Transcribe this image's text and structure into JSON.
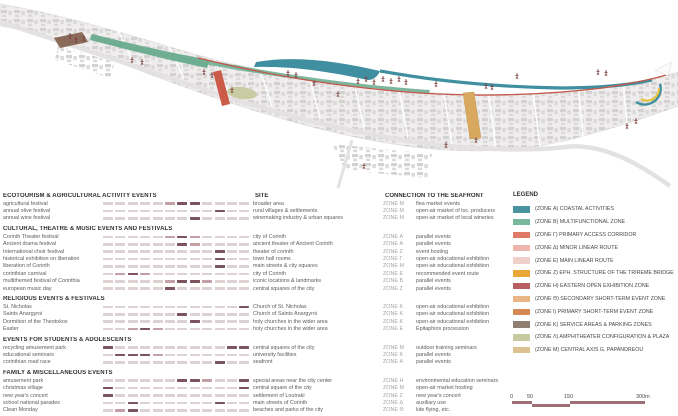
{
  "table": {
    "column_headers": {
      "site": "SITE",
      "connection": "CONNECTION TO THE SEAFRONT"
    },
    "groups": [
      {
        "header": "ECOTOURISM & AGRICULTURAL ACTIVITY EVENTS",
        "rows": [
          {
            "event": "agricultural festival",
            "site": "broader area",
            "zone": "ZONE Μ",
            "connection": "flea market events",
            "months": [
              0,
              0,
              0,
              0,
              0,
              1,
              2,
              2,
              0,
              0,
              0,
              0
            ]
          },
          {
            "event": "annual olive festival",
            "site": "rural villages & settlements",
            "zone": "ZONE Μ",
            "connection": "open-air market of loc. producers",
            "months": [
              0,
              0,
              0,
              0,
              0,
              0,
              0,
              0,
              0,
              2,
              0,
              0
            ]
          },
          {
            "event": "annual wine festival",
            "site": "winemaking industry & urban squares",
            "zone": "ZONE Μ",
            "connection": "open-air market of local wineries",
            "months": [
              0,
              0,
              0,
              0,
              0,
              0,
              0,
              2,
              0,
              0,
              0,
              0
            ]
          }
        ]
      },
      {
        "header": "CULTURAL, THEATRE & MUSIC EVENTS AND FESTIVALS",
        "rows": [
          {
            "event": "Corinth Theater festival",
            "site": "city of Corinth",
            "zone": "ZONE Α",
            "connection": "parallel events",
            "months": [
              0,
              0,
              0,
              0,
              0,
              1,
              2,
              1,
              0,
              0,
              0,
              0
            ]
          },
          {
            "event": "Ancient drama festival",
            "site": "ancient theater of Ancient Corinth",
            "zone": "ZONE Α",
            "connection": "parallel events",
            "months": [
              0,
              0,
              0,
              0,
              0,
              0,
              2,
              1,
              0,
              0,
              0,
              0
            ]
          },
          {
            "event": "International choir festival",
            "site": "theater of corinth",
            "zone": "ZONE Ζ",
            "connection": "event hosting",
            "months": [
              0,
              0,
              0,
              0,
              0,
              0,
              0,
              0,
              0,
              2,
              0,
              0
            ]
          },
          {
            "event": "historical exhibition on liberation",
            "site": "town hall rooms",
            "zone": "ZONE Γ",
            "connection": "open-air educational exhibition",
            "months": [
              0,
              0,
              0,
              0,
              0,
              0,
              0,
              0,
              0,
              2,
              0,
              0
            ]
          },
          {
            "event": "liberation of Corinth",
            "site": "main streets & city squares",
            "zone": "ZONE Μ",
            "connection": "open-air educational exhibition",
            "months": [
              0,
              0,
              0,
              0,
              0,
              0,
              0,
              0,
              0,
              2,
              0,
              0
            ]
          },
          {
            "event": "corinthian carnival",
            "site": "city of Corinth",
            "zone": "ZONE Ε",
            "connection": "recommended event route",
            "months": [
              0,
              1,
              2,
              1,
              0,
              0,
              0,
              0,
              0,
              0,
              0,
              0
            ]
          },
          {
            "event": "multithemed festival of Corinthia",
            "site": "iconic locations & landmarks",
            "zone": "ZONE Β",
            "connection": "parallel events",
            "months": [
              0,
              0,
              0,
              0,
              0,
              1,
              2,
              2,
              1,
              0,
              0,
              0
            ]
          },
          {
            "event": "european music day",
            "site": "central squares of the city",
            "zone": "ZONE Ζ",
            "connection": "parallel events",
            "months": [
              0,
              0,
              0,
              0,
              0,
              2,
              0,
              0,
              0,
              0,
              0,
              0
            ]
          }
        ]
      },
      {
        "header": "RELIGIOUS EVENTS & FESTIVALS",
        "rows": [
          {
            "event": "St. Nicholas",
            "site": "Church of St. Nicholas",
            "zone": "ZONE Κ",
            "connection": "open-air educational exhibition",
            "months": [
              0,
              0,
              0,
              0,
              0,
              0,
              0,
              0,
              0,
              0,
              0,
              2
            ]
          },
          {
            "event": "Saints Anargyroi",
            "site": "Church of Saints Anargyroi",
            "zone": "ZONE Κ",
            "connection": "open-air educational exhibition",
            "months": [
              0,
              0,
              0,
              0,
              0,
              0,
              2,
              0,
              0,
              0,
              0,
              0
            ]
          },
          {
            "event": "Dormition of the Theotokos",
            "site": "holy churches in the wider area",
            "zone": "ZONE Κ",
            "connection": "open-air educational exhibition",
            "months": [
              0,
              0,
              0,
              0,
              0,
              0,
              0,
              2,
              0,
              0,
              0,
              0
            ]
          },
          {
            "event": "Easter",
            "site": "holy churches in the wider area",
            "zone": "ZONE Ε",
            "connection": "Epitaphios procession",
            "months": [
              0,
              0,
              1,
              2,
              1,
              0,
              0,
              0,
              0,
              0,
              0,
              0
            ]
          }
        ]
      },
      {
        "header": "EVENTS FOR STUDENTS & ADOLESCENTS",
        "rows": [
          {
            "event": "recycling amusement park",
            "site": "central squares of the city",
            "zone": "ZONE Μ",
            "connection": "outdoor training seminars",
            "months": [
              2,
              0,
              0,
              0,
              0,
              0,
              0,
              0,
              0,
              0,
              2,
              2
            ]
          },
          {
            "event": "educational seminars",
            "site": "university facilities",
            "zone": "ZONE Κ",
            "connection": "parallel events",
            "months": [
              0,
              2,
              2,
              2,
              1,
              0,
              0,
              0,
              0,
              0,
              0,
              0
            ]
          },
          {
            "event": "corinthian road race",
            "site": "seafront",
            "zone": "ZONE Α",
            "connection": "parallel events",
            "months": [
              0,
              0,
              0,
              0,
              0,
              0,
              0,
              0,
              0,
              2,
              0,
              0
            ]
          }
        ]
      },
      {
        "header": "FAMILY & MISCELLANEOUS EVENTS",
        "rows": [
          {
            "event": "amusement park",
            "site": "special areas near the city center",
            "zone": "ZONE Η",
            "connection": "environmental education seminars",
            "months": [
              0,
              0,
              0,
              0,
              0,
              0,
              2,
              2,
              1,
              0,
              0,
              2
            ]
          },
          {
            "event": "christmas village",
            "site": "central square of the city",
            "zone": "ZONE Μ",
            "connection": "open-air market hosting",
            "months": [
              2,
              0,
              0,
              0,
              0,
              0,
              0,
              0,
              0,
              0,
              0,
              2
            ]
          },
          {
            "event": "new year's concert",
            "site": "settlement of Loutraki",
            "zone": "ZONE Ζ",
            "connection": "new year's concert",
            "months": [
              2,
              0,
              0,
              0,
              0,
              0,
              0,
              0,
              0,
              0,
              0,
              0
            ]
          },
          {
            "event": "school national parades",
            "site": "main streets of Corinth",
            "zone": "ZONE Δ",
            "connection": "auxiliary use",
            "months": [
              0,
              0,
              2,
              0,
              0,
              0,
              0,
              0,
              0,
              2,
              0,
              0
            ]
          },
          {
            "event": "Clean Monday",
            "site": "beaches and parks of the city",
            "zone": "ZONE Θ",
            "connection": "kite flying, etc.",
            "months": [
              0,
              1,
              2,
              0,
              0,
              0,
              0,
              0,
              0,
              0,
              0,
              0
            ]
          }
        ]
      }
    ]
  },
  "legend": {
    "title": "LEGEND",
    "items": [
      {
        "label": "(ZONE Α) COASTAL ACTIVITIES",
        "color": "#4a93a0"
      },
      {
        "label": "(ZONE Β) MULTIFUNCTIONAL ZONE",
        "color": "#7ab89e"
      },
      {
        "label": "(ZONE Γ) PRIMARY ACCESS CORRIDOR",
        "color": "#e07a68"
      },
      {
        "label": "(ZONE Δ) MINOR LINEAR ROUTE",
        "color": "#edb6ae"
      },
      {
        "label": "(ZONE Ε) MAIN LINEAR ROUTE",
        "color": "#f0d0cb"
      },
      {
        "label": "(ZONE Ζ) EPH. STRUCTURE OF THE TRIREME BRIDGE",
        "color": "#eaa838"
      },
      {
        "label": "(ZONE Η) EASTERN OPEN EXHIBITION ZONE",
        "color": "#b85f62"
      },
      {
        "label": "(ZONE Θ) SECONDARY SHORT-TERM EVENT ZONE",
        "color": "#eab584"
      },
      {
        "label": "(ZONE Ι) PRIMARY SHORT-TERM EVENT ZONE",
        "color": "#d48a52"
      },
      {
        "label": "(ZONE Κ) SERVICE AREAS & PARKING ZONES",
        "color": "#8f7f72"
      },
      {
        "label": "(ZONE Λ) AMPHITHEATER CONFIGURATION & PLAZA",
        "color": "#c8cba0"
      },
      {
        "label": "(ZONE Μ) CENTRAL AXIS G. PAPANDREOU",
        "color": "#dcc391"
      }
    ]
  },
  "scalebar": {
    "labels": [
      "0",
      "50",
      "150",
      "300m"
    ]
  },
  "map_colors": {
    "land": "#efeded",
    "buildings": "#c9c5c5",
    "coastal_teal": "#3f8fa0",
    "multifunctional_green": "#7cb69c",
    "promenade_red": "#c4574a",
    "amphitheater_olive": "#c9cba2",
    "central_axis_tan": "#d9a85f",
    "trireme_amber": "#e8c23a",
    "figures": "#7d4040"
  },
  "colors": {
    "matrix_off": "#ddd2d2",
    "matrix_mid": "#c2a0a6",
    "matrix_on": "#7b545e",
    "header_text": "#332f2f",
    "body_text": "#5f5a5a",
    "zone_text": "#a8a2a2",
    "scalebar": "#9c6f77"
  }
}
